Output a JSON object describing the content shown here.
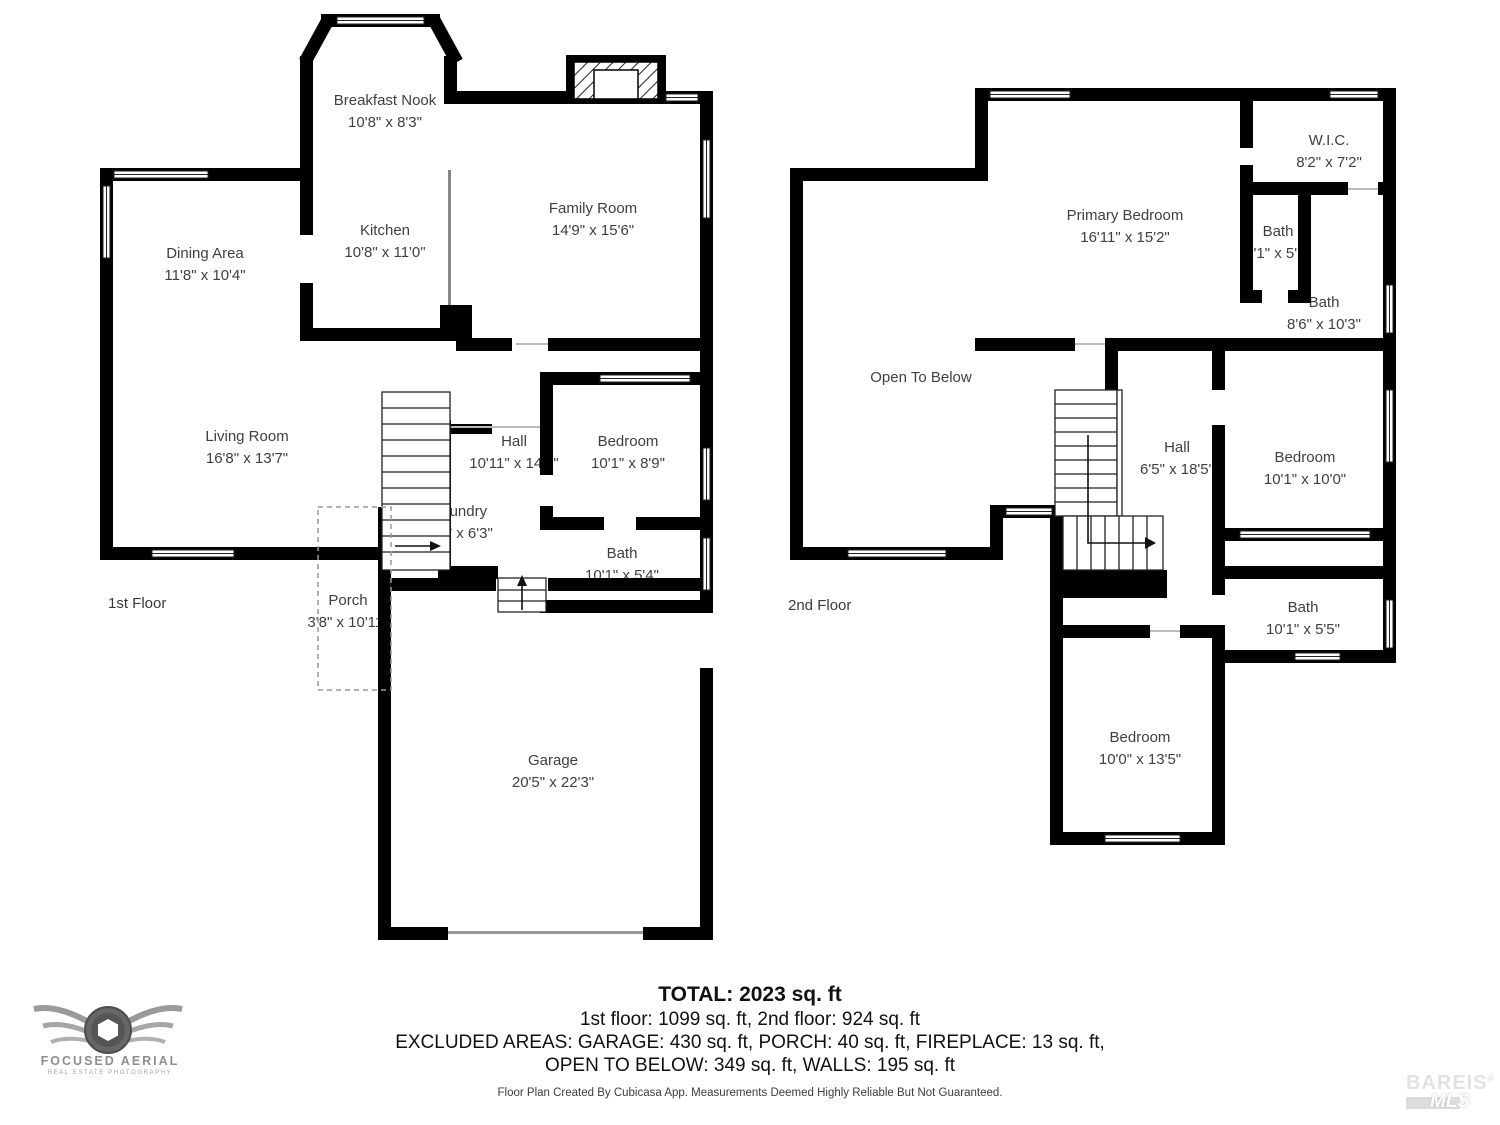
{
  "floor1": {
    "label": "1st Floor",
    "rooms": [
      {
        "name": "Breakfast Nook",
        "dims": "10'8\" x 8'3\""
      },
      {
        "name": "Kitchen",
        "dims": "10'8\" x 11'0\""
      },
      {
        "name": "Dining Area",
        "dims": "11'8\" x 10'4\""
      },
      {
        "name": "Family Room",
        "dims": "14'9\" x 15'6\""
      },
      {
        "name": "Living Room",
        "dims": "16'8\" x 13'7\""
      },
      {
        "name": "Hall",
        "dims": "10'11\" x 14'1\""
      },
      {
        "name": "Bedroom",
        "dims": "10'1\" x 8'9\""
      },
      {
        "name": "Laundry",
        "dims": "7'9\" x 6'3\""
      },
      {
        "name": "Bath",
        "dims": "10'1\" x 5'4\""
      },
      {
        "name": "Porch",
        "dims": "3'8\" x 10'11\""
      },
      {
        "name": "Garage",
        "dims": "20'5\" x 22'3\""
      }
    ]
  },
  "floor2": {
    "label": "2nd Floor",
    "rooms": [
      {
        "name": "Primary Bedroom",
        "dims": "16'11\" x 15'2\""
      },
      {
        "name": "W.I.C.",
        "dims": "8'2\" x 7'2\""
      },
      {
        "name": "Bath",
        "dims": "3'1\" x 5'7\""
      },
      {
        "name": "Bath",
        "dims": "8'6\" x 10'3\""
      },
      {
        "name": "Open To Below",
        "dims": ""
      },
      {
        "name": "Hall",
        "dims": "6'5\" x 18'5\""
      },
      {
        "name": "Bedroom",
        "dims": "10'1\" x 10'0\""
      },
      {
        "name": "Bath",
        "dims": "10'1\" x 5'5\""
      },
      {
        "name": "Bedroom",
        "dims": "10'0\" x 13'5\""
      }
    ]
  },
  "summary": {
    "total": "TOTAL: 2023 sq. ft",
    "floors": "1st floor: 1099 sq. ft, 2nd floor: 924 sq. ft",
    "excluded1": "EXCLUDED AREAS: GARAGE: 430 sq. ft, PORCH: 40 sq. ft, FIREPLACE: 13 sq. ft,",
    "excluded2": "OPEN TO BELOW: 349 sq. ft, WALLS: 195 sq. ft",
    "disclaimer": "Floor Plan Created By Cubicasa App. Measurements Deemed Highly Reliable But Not Guaranteed."
  },
  "logos": {
    "left_name": "FOCUSED AERIAL",
    "left_tagline": "REAL ESTATE PHOTOGRAPHY",
    "right_name": "BAREIS",
    "right_reg": "®",
    "right_sub": "MLS"
  },
  "colors": {
    "wall": "#000000",
    "label_text": "#3f3f3f",
    "logo_gray": "#8e8e8e",
    "watermark": "#e2e2e6"
  }
}
